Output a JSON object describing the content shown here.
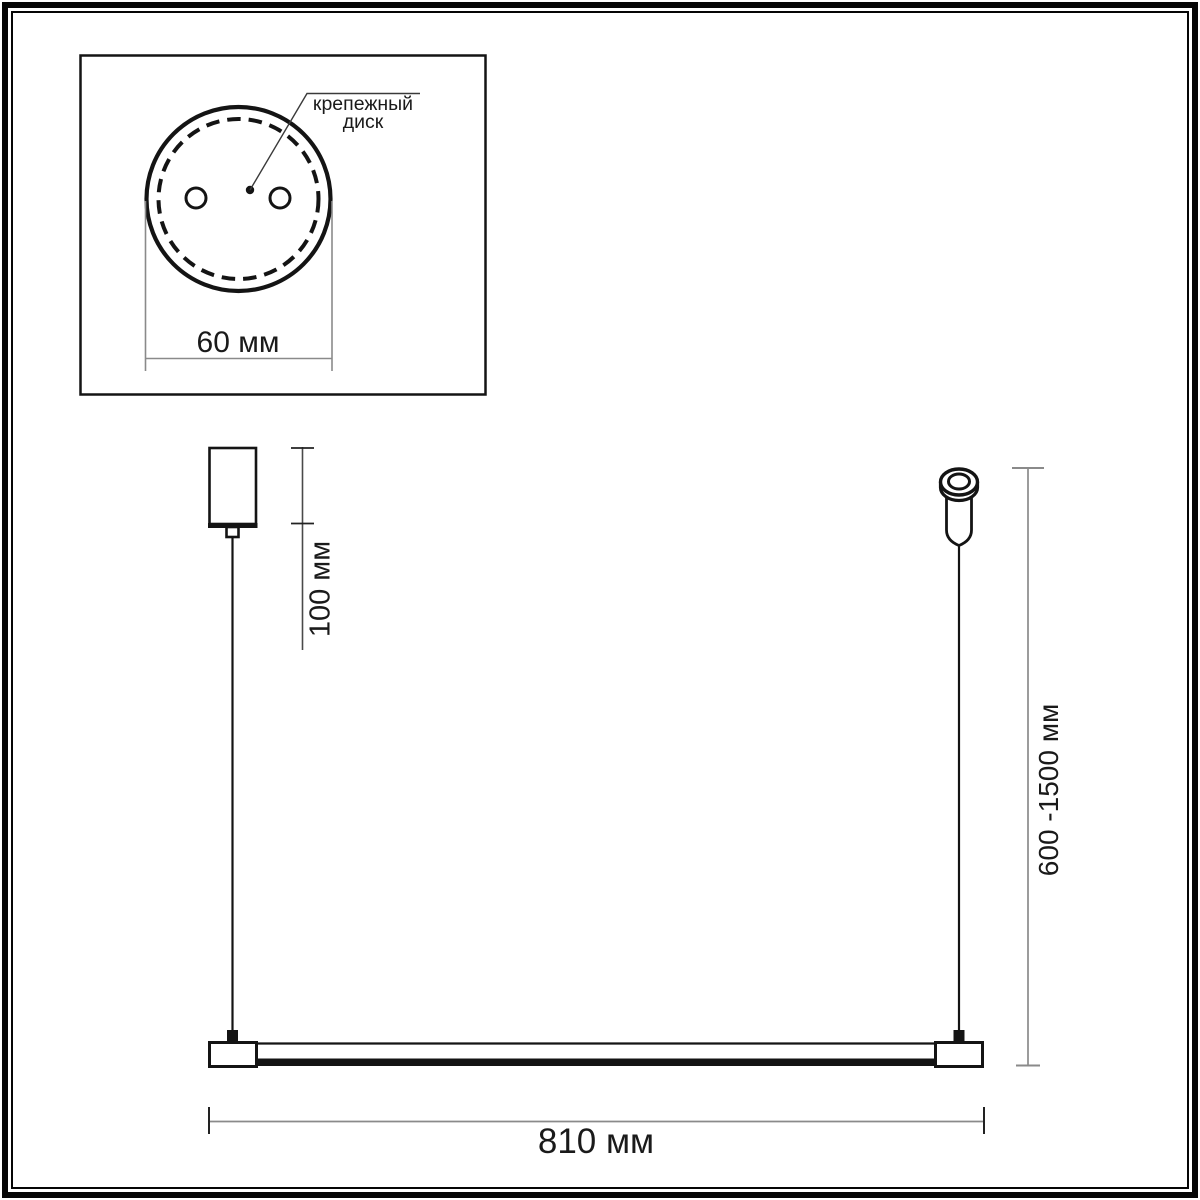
{
  "inset_view": {
    "callout": {
      "line1": "крепежный",
      "line2": "диск"
    },
    "disk_diameter": "60 мм"
  },
  "dimensions": {
    "canopy_drop": "100 мм",
    "suspension_range": "600 -1500 мм",
    "fixture_length": "810 мм"
  },
  "colors": {
    "outline": "#141414",
    "dimension_line": "#8a8a8a",
    "tick": "#222222",
    "text": "#1a1a1a",
    "frame": "#050505",
    "background": "#ffffff"
  }
}
